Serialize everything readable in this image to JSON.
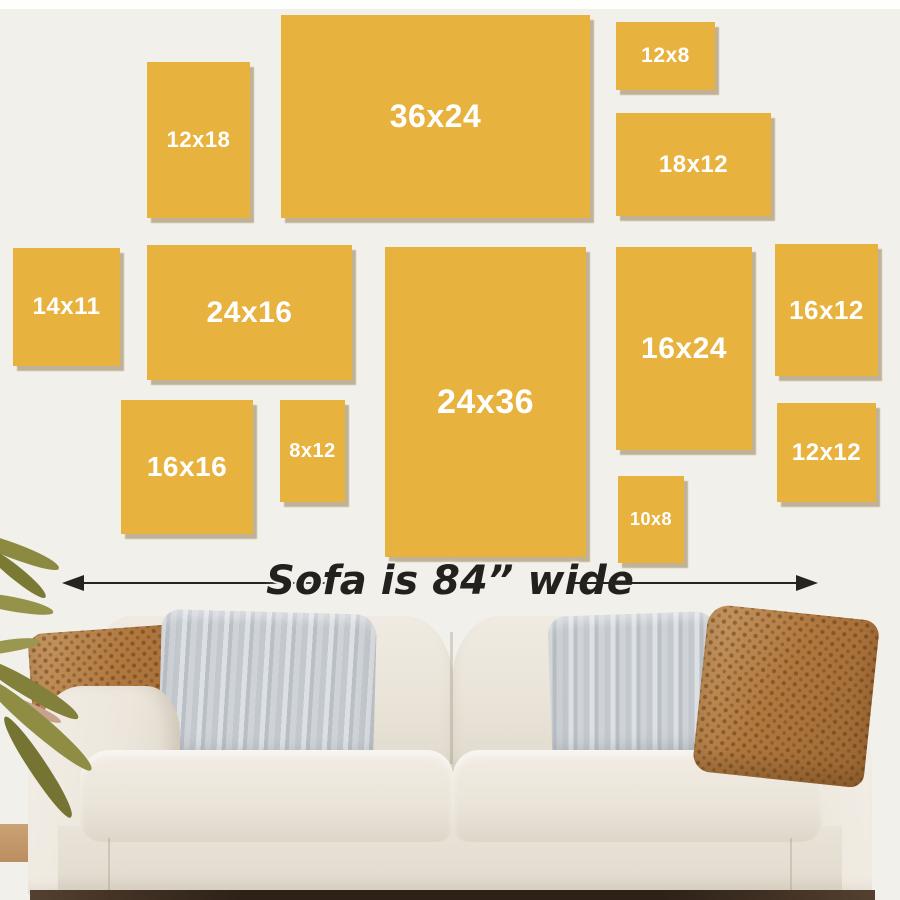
{
  "guide": {
    "caption": "Sofa is 84” wide",
    "frames": [
      {
        "label": "12x18",
        "x": 147,
        "y": 62,
        "w": 103,
        "h": 156,
        "fs": 22
      },
      {
        "label": "36x24",
        "x": 281,
        "y": 15,
        "w": 309,
        "h": 203,
        "fs": 32
      },
      {
        "label": "12x8",
        "x": 616,
        "y": 22,
        "w": 99,
        "h": 68,
        "fs": 21
      },
      {
        "label": "18x12",
        "x": 616,
        "y": 113,
        "w": 155,
        "h": 103,
        "fs": 24
      },
      {
        "label": "14x11",
        "x": 13,
        "y": 248,
        "w": 107,
        "h": 118,
        "fs": 24
      },
      {
        "label": "24x16",
        "x": 147,
        "y": 245,
        "w": 205,
        "h": 135,
        "fs": 30
      },
      {
        "label": "24x36",
        "x": 385,
        "y": 247,
        "w": 201,
        "h": 310,
        "fs": 34
      },
      {
        "label": "16x24",
        "x": 616,
        "y": 247,
        "w": 136,
        "h": 203,
        "fs": 30
      },
      {
        "label": "16x12",
        "x": 775,
        "y": 244,
        "w": 103,
        "h": 132,
        "fs": 26
      },
      {
        "label": "16x16",
        "x": 121,
        "y": 400,
        "w": 132,
        "h": 134,
        "fs": 28
      },
      {
        "label": "8x12",
        "x": 280,
        "y": 400,
        "w": 65,
        "h": 102,
        "fs": 20
      },
      {
        "label": "10x8",
        "x": 618,
        "y": 476,
        "w": 66,
        "h": 87,
        "fs": 18
      },
      {
        "label": "12x12",
        "x": 777,
        "y": 403,
        "w": 99,
        "h": 99,
        "fs": 24
      }
    ]
  },
  "colors": {
    "wall": "#f2f0ea",
    "frame_yellow": "#e8b23e",
    "frame_shadow": "#7b5e24",
    "frame_label_text": "#ffffff",
    "annotation_text": "#23211e",
    "sofa_cream": "#ece6dc",
    "pillow_rust": "#b0783f",
    "pillow_gray": "#ccd0d5",
    "plant_olive": "#83813a",
    "floor_dark": "#2e2118"
  }
}
